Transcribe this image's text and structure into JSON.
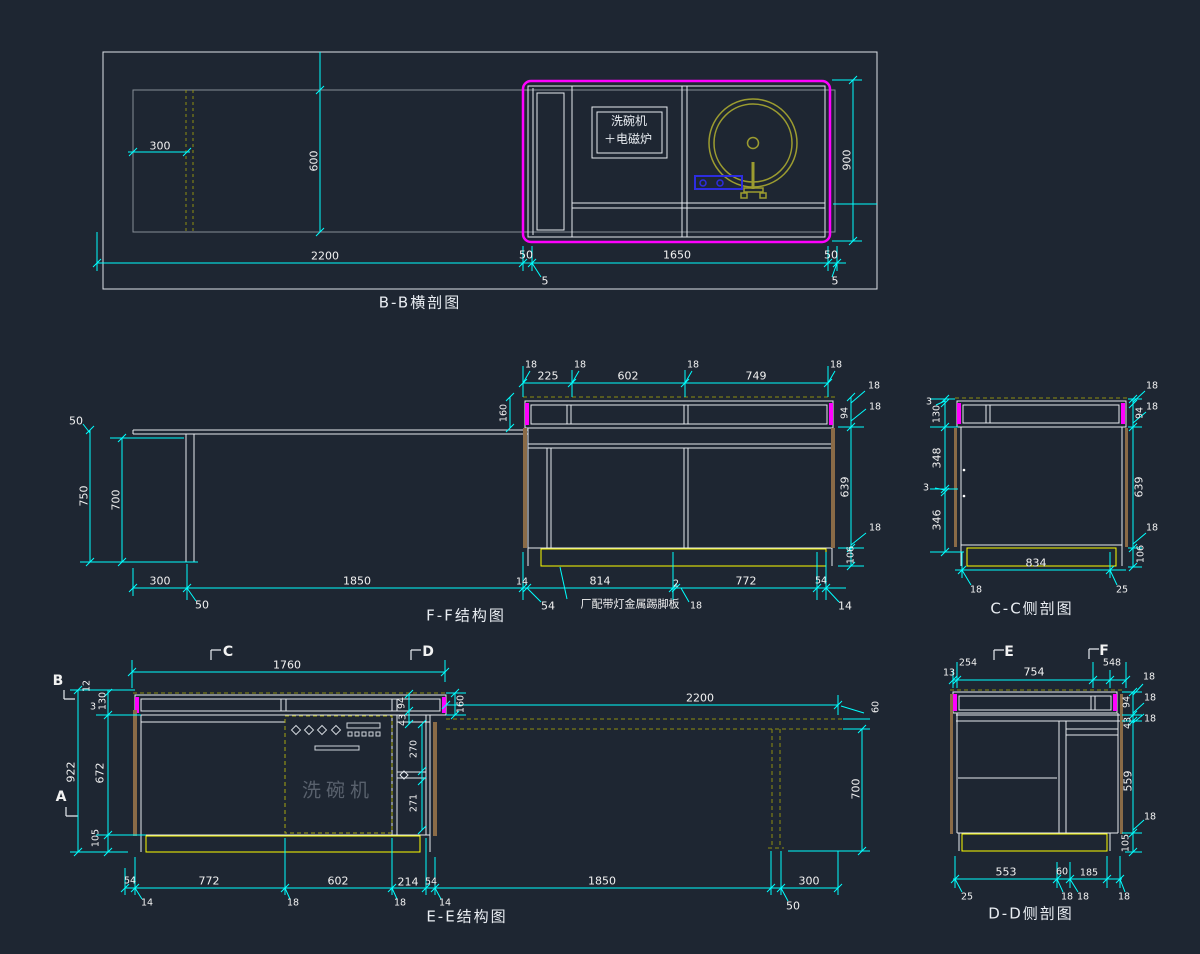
{
  "app": {
    "name": "cad-drawing-viewer",
    "background": "#1e2632"
  },
  "colors": {
    "dimension": "#00ffff",
    "outline": "#dde2e8",
    "carcass_gray": "#878d96",
    "highlight_magenta": "#ff00ff",
    "plinth_yellow": "#ffff00",
    "hidden_olive": "#8f8f10",
    "panel_tan": "#8a6b47",
    "appliance_blue": "#2d2de0"
  },
  "views": {
    "bb": {
      "title": "B-B横剖图",
      "appliance_line1": "洗碗机",
      "appliance_line2": "＋电磁炉"
    },
    "ff": {
      "title": "F-F结构图",
      "plinth_callout": "厂配带灯金属踢脚板"
    },
    "cc": {
      "title": "C-C侧剖图"
    },
    "ee": {
      "title": "E-E结构图",
      "dishwasher_label": "洗碗机"
    },
    "dd": {
      "title": "D-D侧剖图"
    }
  },
  "markers": {
    "A": "A",
    "B": "B",
    "C": "C",
    "D": "D",
    "E": "E",
    "F": "F"
  },
  "dims": {
    "v2": "2",
    "v3": "3",
    "v5": "5",
    "v12": "12",
    "v13": "13",
    "v14": "14",
    "v18": "18",
    "v25": "25",
    "v43": "43",
    "v50": "50",
    "v54": "54",
    "v60": "60",
    "v94": "94",
    "v105": "105",
    "v106": "106",
    "v130": "130",
    "v160": "160",
    "v185": "185",
    "v214": "214",
    "v225": "225",
    "v254": "254",
    "v270": "270",
    "v271": "271",
    "v300": "300",
    "v346": "346",
    "v348": "348",
    "v548": "548",
    "v553": "553",
    "v559": "559",
    "v600": "600",
    "v602": "602",
    "v639": "639",
    "v672": "672",
    "v700": "700",
    "v749": "749",
    "v750": "750",
    "v754": "754",
    "v772": "772",
    "v814": "814",
    "v834": "834",
    "v900": "900",
    "v922": "922",
    "v1650": "1650",
    "v1760": "1760",
    "v1850": "1850",
    "v2200": "2200"
  }
}
